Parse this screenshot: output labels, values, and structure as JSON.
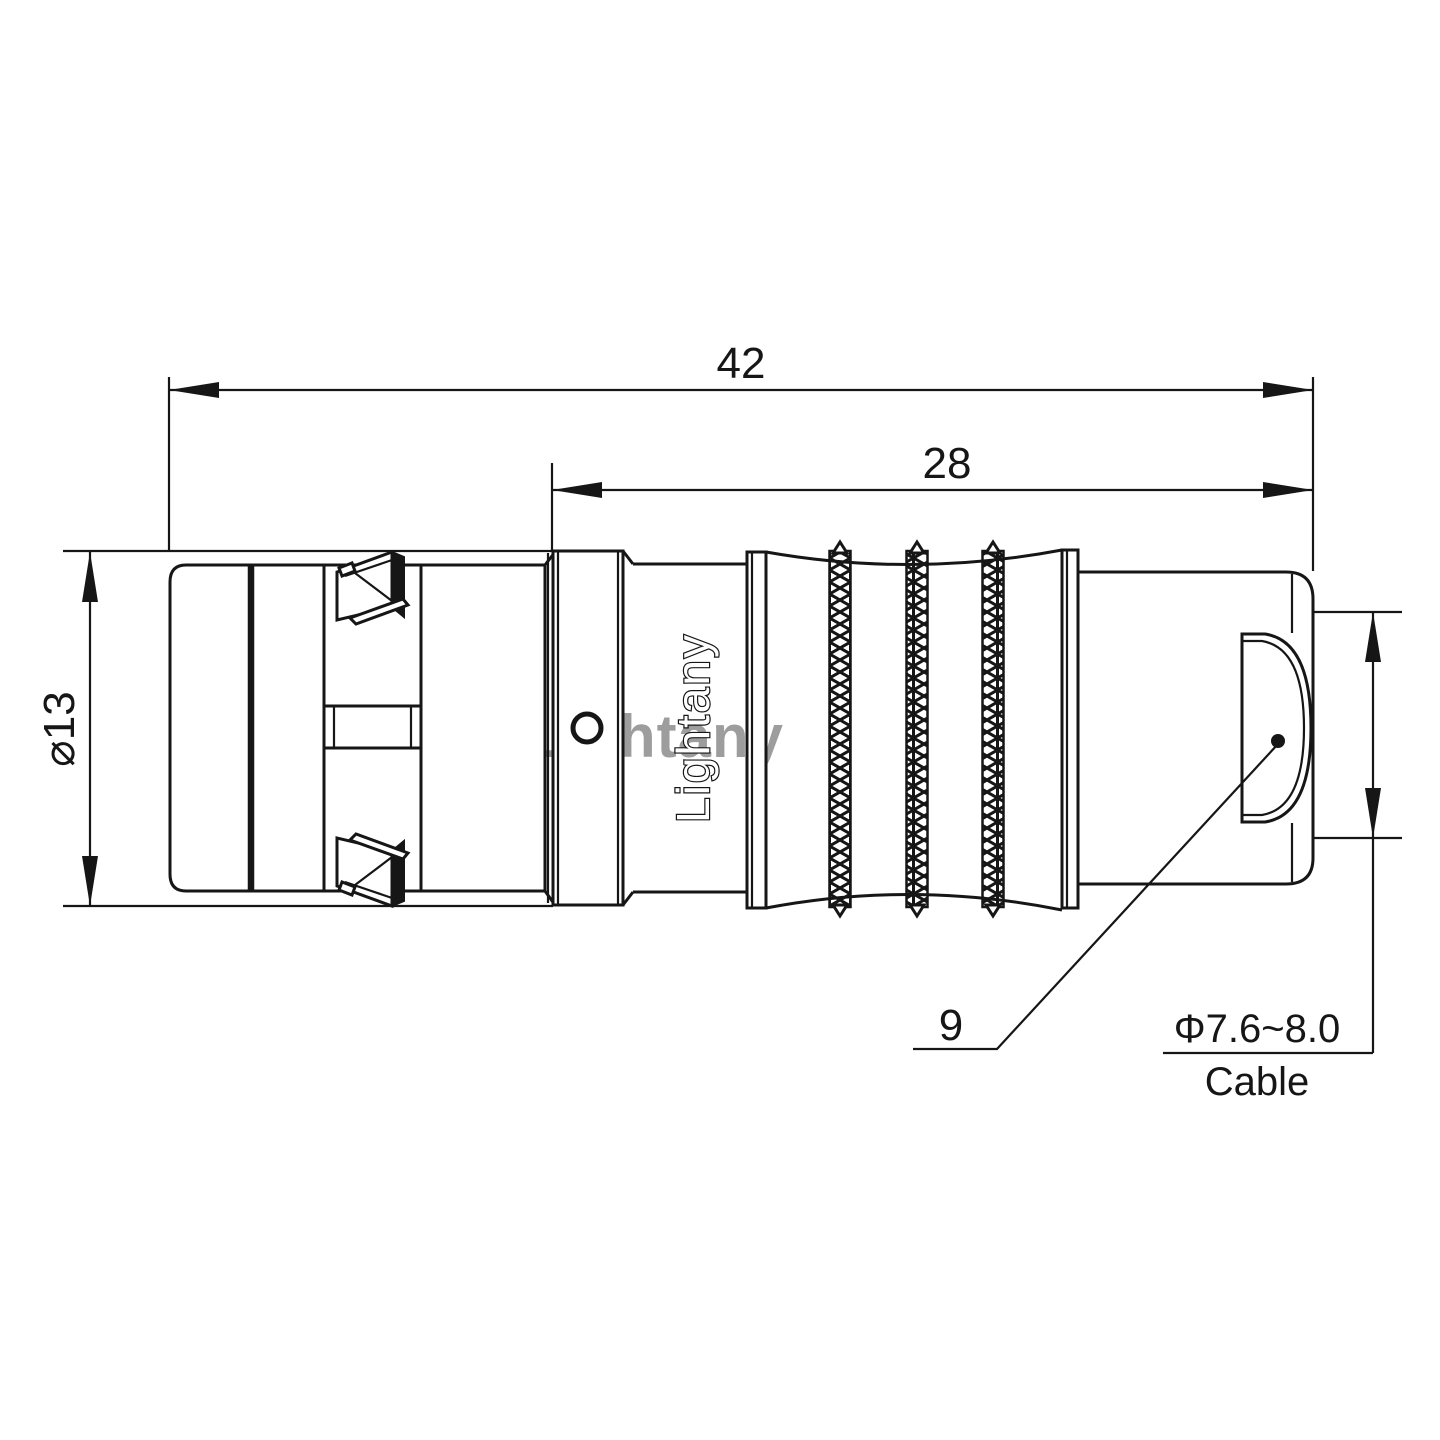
{
  "sheet": {
    "background": "#ffffff",
    "line_color": "#161616"
  },
  "watermark": {
    "text": "Lightany",
    "color": "#dd6f6f"
  },
  "connector": {
    "brand_text": "Lightany"
  },
  "dimensions": {
    "overall_length": "42",
    "rear_length": "28",
    "outer_diameter": "⌀13",
    "shell_size": "9",
    "cable_range": "Φ7.6~8.0",
    "cable_label": "Cable"
  }
}
